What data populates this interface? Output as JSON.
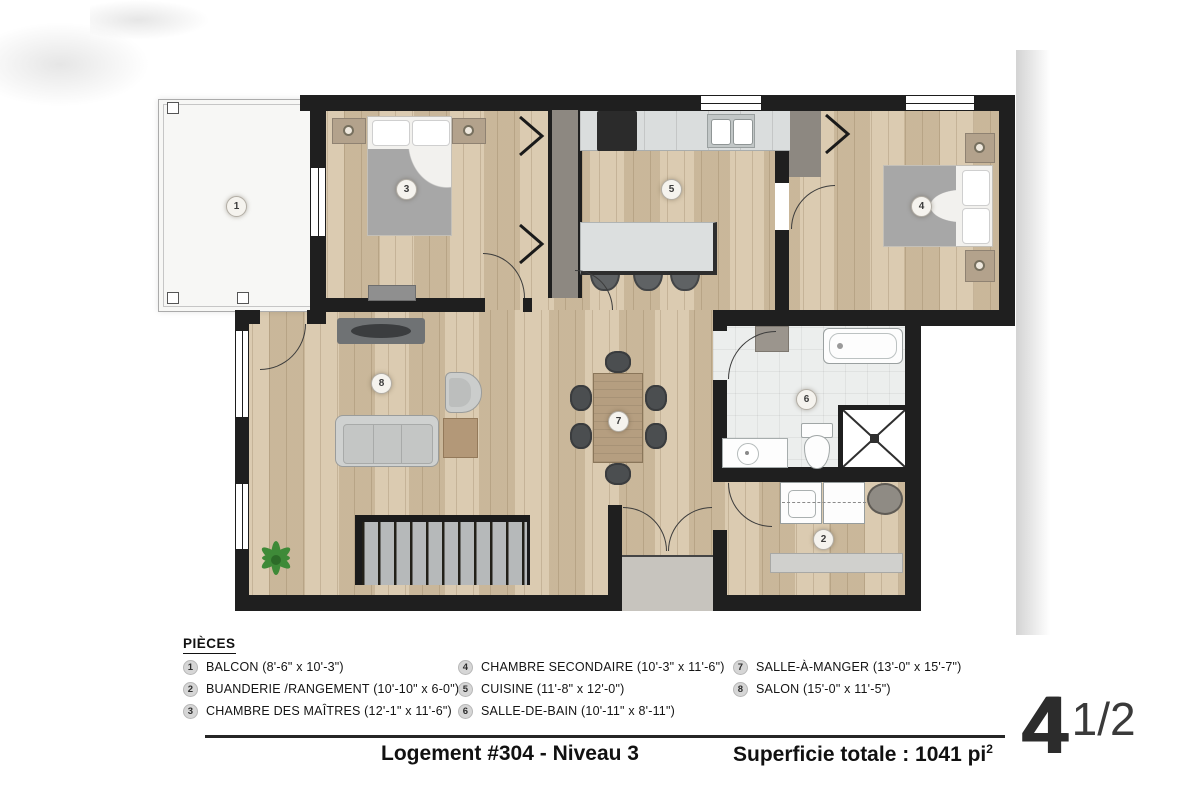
{
  "legend": {
    "title": "PIÈCES"
  },
  "rooms": [
    {
      "num": "1",
      "label": "BALCON (8'-6\" x 10'-3\")"
    },
    {
      "num": "2",
      "label": "BUANDERIE /RANGEMENT (10'-10\" x 6-0\")"
    },
    {
      "num": "3",
      "label": "CHAMBRE DES MAÎTRES (12'-1\" x 11'-6\")"
    },
    {
      "num": "4",
      "label": "CHAMBRE SECONDAIRE (10'-3\" x 11'-6\")"
    },
    {
      "num": "5",
      "label": "CUISINE (11'-8\" x 12'-0\")"
    },
    {
      "num": "6",
      "label": "SALLE-DE-BAIN (10'-11\" x 8'-11\")"
    },
    {
      "num": "7",
      "label": "SALLE-À-MANGER (13'-0\" x 15'-7\")"
    },
    {
      "num": "8",
      "label": "SALON (15'-0\" x 11'-5\")"
    }
  ],
  "footer": {
    "unit_title": "Logement #304 - Niveau 3",
    "area_label": "Superficie totale : 1041 pi",
    "area_exponent": "2",
    "unit_size_main": "4",
    "unit_size_fraction": "1/2"
  },
  "colors": {
    "wall": "#1f1f1f",
    "wood_floor": "#d6c4a6",
    "bath_tile": "#eceeed",
    "balcony": "#f7f7f5",
    "furniture_gray": "#cfd1d0",
    "plant_green": "#3e8a38"
  }
}
